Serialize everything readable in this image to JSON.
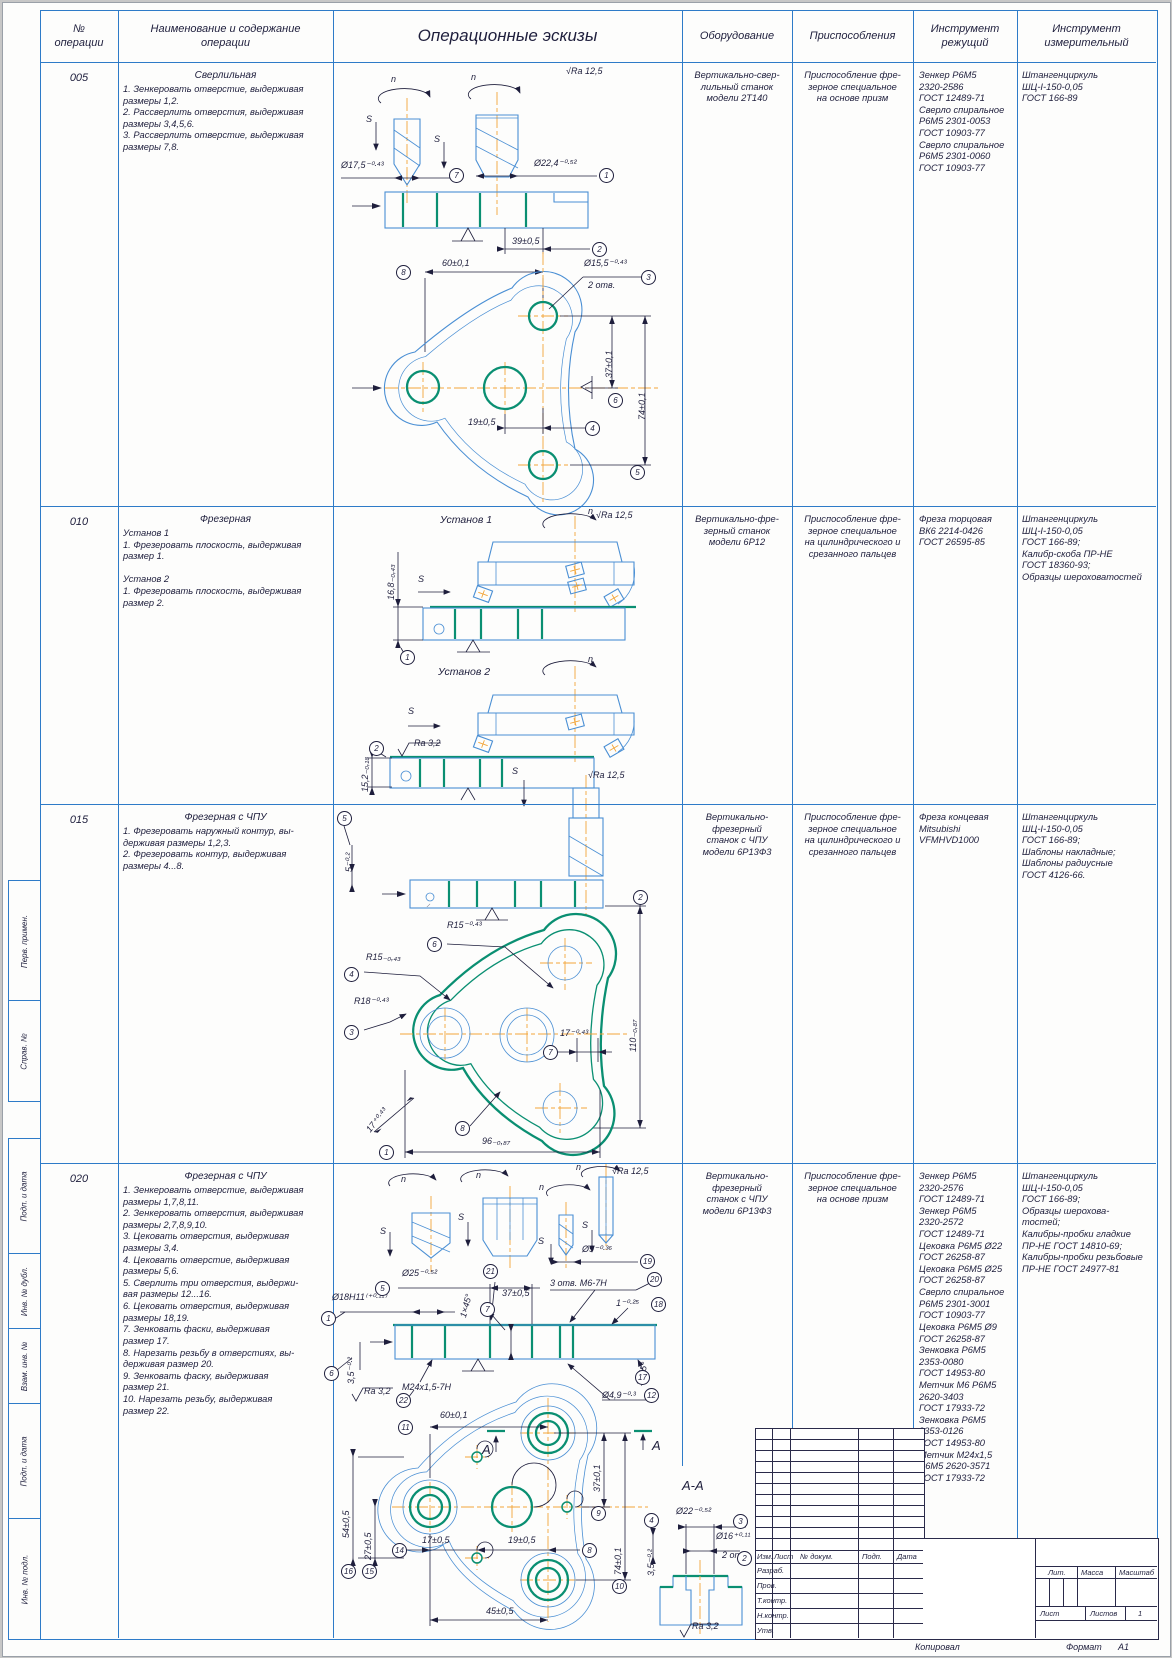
{
  "header": {
    "col_op_num": "№\nоперации",
    "col_name": "Наименование и содержание\nоперации",
    "col_sketch": "Операционные эскизы",
    "col_equipment": "Оборудование",
    "col_fixture": "Приспособления",
    "col_cutting": "Инструмент\nрежущий",
    "col_measuring": "Инструмент\nизмерительный"
  },
  "operations": [
    {
      "num": "005",
      "title": "Сверлильная",
      "steps": "1. Зенкеровать отверстие, выдерживая\nразмеры 1,2.\n2. Рассверлить отверстия, выдерживая\nразмеры 3,4,5,6.\n3. Рассверлить отверстие, выдерживая\nразмеры 7,8.",
      "equipment": "Вертикально-свер-\nлильный станок\nмодели 2Т140",
      "fixture": "Приспособление фре-\nзерное специальное\nна основе призм",
      "cutting": "Зенкер Р6М5\n2320-2586\nГОСТ 12489-71\nСверло спиральное\nР6М5 2301-0053\nГОСТ 10903-77\nСверло спиральное\nР6М5 2301-0060\nГОСТ 10903-77",
      "measuring": "Штангенциркуль\nШЦ-I-150-0,05\nГОСТ 166-89"
    },
    {
      "num": "010",
      "title": "Фрезерная",
      "steps": "Установ 1\n1. Фрезеровать плоскость, выдерживая\nразмер 1.\n\nУстанов 2\n1. Фрезеровать плоскость, выдерживая\nразмер 2.",
      "equipment": "Вертикально-фре-\nзерный станок\nмодели 6Р12",
      "fixture": "Приспособление фре-\nзерное специальное\nна цилиндрического и\nсрезанного пальцев",
      "cutting": "Фреза торцовая\nВК6 2214-0426\nГОСТ 26595-85",
      "measuring": "Штангенциркуль\nШЦ-I-150-0,05\nГОСТ 166-89;\nКалибр-скоба ПР-НЕ\nГОСТ 18360-93;\nОбразцы шероховатостей"
    },
    {
      "num": "015",
      "title": "Фрезерная с ЧПУ",
      "steps": "1. Фрезеровать наружный контур, вы-\nдерживая размеры 1,2,3.\n2. Фрезеровать контур, выдерживая\nразмеры 4...8.",
      "equipment": "Вертикально-\nфрезерный\nстанок с ЧПУ\nмодели 6Р13Ф3",
      "fixture": "Приспособление фре-\nзерное специальное\nна цилиндрического и\nсрезанного пальцев",
      "cutting": "Фреза концевая\nMitsubishi\nVFMHVD1000",
      "measuring": "Штангенциркуль\nШЦ-I-150-0,05\nГОСТ 166-89;\nШаблоны накладные;\nШаблоны радиусные\nГОСТ 4126-66."
    },
    {
      "num": "020",
      "title": "Фрезерная с ЧПУ",
      "steps": "1. Зенкеровать отверстие, выдерживая\nразмеры 1,7,8,11.\n2. Зенкеровать отверстия, выдерживая\nразмеры 2,7,8,9,10.\n3. Цековать отверстия, выдерживая\nразмеры 3,4.\n4. Цековать отверстие, выдерживая\nразмеры 5,6.\n5. Сверлить три отверстия, выдержи-\nвая размеры 12...16.\n6. Цековать отверстия, выдерживая\nразмеры 18,19.\n7. Зенковать фаски, выдерживая\nразмер 17.\n8. Нарезать резьбу в отверстиях, вы-\nдерживая размер 20.\n9. Зенковать фаску, выдерживая\nразмер 21.\n10. Нарезать резьбу, выдерживая\nразмер 22.",
      "equipment": "Вертикально-\nфрезерный\nстанок с ЧПУ\nмодели 6Р13Ф3",
      "fixture": "Приспособление фре-\nзерное специальное\nна основе призм",
      "cutting": "Зенкер Р6М5\n2320-2576\nГОСТ 12489-71\nЗенкер Р6М5\n2320-2572\nГОСТ 12489-71\nЦековка Р6М5 Ø22\nГОСТ 26258-87\nЦековка Р6М5 Ø25\nГОСТ 26258-87\nСверло спиральное\nР6М5 2301-3001\nГОСТ 10903-77\nЦековка Р6М5 Ø9\nГОСТ 26258-87\nЗенковка Р6М5\n2353-0080\nГОСТ 14953-80\nМетчик М6 Р6М5\n2620-3403\nГОСТ 17933-72\nЗенковка Р6М5\n2353-0126\nГОСТ 14953-80\nМетчик М24х1,5\nР6М5 2620-3571\nГОСТ 17933-72",
      "measuring": "Штангенциркуль\nШЦ-I-150-0,05\nГОСТ 166-89;\nОбразцы шерохова-\nтостей;\nКалибры-пробки гладкие\nПР-НЕ ГОСТ 14810-69;\nКалибры-пробки резьбовые\nПР-НЕ ГОСТ 24977-81"
    }
  ],
  "annotations": [
    {
      "t": "√Ra 12,5",
      "x": 566,
      "y": 66
    },
    {
      "t": "n",
      "x": 391,
      "y": 74
    },
    {
      "t": "n",
      "x": 471,
      "y": 72
    },
    {
      "t": "S",
      "x": 366,
      "y": 114
    },
    {
      "t": "S",
      "x": 434,
      "y": 134
    },
    {
      "t": "Ø17,5⁻⁰·⁴³",
      "x": 341,
      "y": 160
    },
    {
      "t": "Ø22,4⁻⁰·⁵²",
      "x": 534,
      "y": 158
    },
    {
      "t": "39±0,5",
      "x": 512,
      "y": 236
    },
    {
      "t": "60±0,1",
      "x": 442,
      "y": 258
    },
    {
      "t": "Ø15,5⁻⁰·⁴³",
      "x": 584,
      "y": 258
    },
    {
      "t": "2 отв.",
      "x": 588,
      "y": 280
    },
    {
      "t": "37±0,1",
      "x": 604,
      "y": 378,
      "r": -90
    },
    {
      "t": "74±0,1",
      "x": 637,
      "y": 420,
      "r": -90
    },
    {
      "t": "19±0,5",
      "x": 468,
      "y": 417
    },
    {
      "t": "Установ 1",
      "x": 440,
      "y": 514,
      "s": 10.5
    },
    {
      "t": "√Ra 12,5",
      "x": 596,
      "y": 510
    },
    {
      "t": "n",
      "x": 588,
      "y": 506
    },
    {
      "t": "S",
      "x": 418,
      "y": 574
    },
    {
      "t": "16,8₋₀,₄₃",
      "x": 386,
      "y": 600,
      "r": -90
    },
    {
      "t": "Установ 2",
      "x": 438,
      "y": 666,
      "s": 10.5
    },
    {
      "t": "n",
      "x": 588,
      "y": 654
    },
    {
      "t": "S",
      "x": 408,
      "y": 706
    },
    {
      "t": "Ra 3,2",
      "x": 414,
      "y": 738
    },
    {
      "t": "15,2₋₀,₁₈",
      "x": 360,
      "y": 792,
      "r": -90
    },
    {
      "t": "√Ra 12,5",
      "x": 588,
      "y": 770
    },
    {
      "t": "S",
      "x": 512,
      "y": 766
    },
    {
      "t": "5⁻⁰·²",
      "x": 344,
      "y": 872,
      "r": -90
    },
    {
      "t": "R15⁻⁰·⁴³",
      "x": 447,
      "y": 920
    },
    {
      "t": "R15₋₀,₄₃",
      "x": 366,
      "y": 952
    },
    {
      "t": "R18⁻⁰·⁴³",
      "x": 354,
      "y": 996
    },
    {
      "t": "17⁻⁰·⁴³",
      "x": 560,
      "y": 1028
    },
    {
      "t": "110₋₀,₈₇",
      "x": 628,
      "y": 1052,
      "r": -90
    },
    {
      "t": "17⁺⁰·⁴³",
      "x": 364,
      "y": 1128,
      "r": -52
    },
    {
      "t": "96₋₀,₈₇",
      "x": 482,
      "y": 1136
    },
    {
      "t": "n",
      "x": 401,
      "y": 1174
    },
    {
      "t": "n",
      "x": 476,
      "y": 1170
    },
    {
      "t": "n",
      "x": 539,
      "y": 1182
    },
    {
      "t": "n",
      "x": 576,
      "y": 1162
    },
    {
      "t": "√Ra 12,5",
      "x": 612,
      "y": 1166
    },
    {
      "t": "S",
      "x": 380,
      "y": 1226
    },
    {
      "t": "S",
      "x": 458,
      "y": 1212
    },
    {
      "t": "S",
      "x": 538,
      "y": 1236
    },
    {
      "t": "S",
      "x": 582,
      "y": 1220
    },
    {
      "t": "Ø9⁻⁰·³⁶",
      "x": 582,
      "y": 1244
    },
    {
      "t": "Ø25⁻⁰·⁵²",
      "x": 402,
      "y": 1268
    },
    {
      "t": "Ø18Н11⁽⁺⁰·¹¹⁾",
      "x": 332,
      "y": 1292
    },
    {
      "t": "1×45°",
      "x": 458,
      "y": 1316,
      "r": -75
    },
    {
      "t": "37±0,5",
      "x": 502,
      "y": 1288
    },
    {
      "t": "3 отв. М6-7Н",
      "x": 550,
      "y": 1278
    },
    {
      "t": "1⁻⁰·²⁵",
      "x": 616,
      "y": 1298
    },
    {
      "t": "3,5⁻⁰·²",
      "x": 346,
      "y": 1384,
      "r": -90
    },
    {
      "t": "М24х1,5-7Н",
      "x": 402,
      "y": 1382
    },
    {
      "t": "Ra 3,2",
      "x": 364,
      "y": 1386
    },
    {
      "t": "1×45°",
      "x": 634,
      "y": 1384,
      "r": -75
    },
    {
      "t": "Ø4,9⁻⁰·³",
      "x": 602,
      "y": 1390
    },
    {
      "t": "60±0,1",
      "x": 440,
      "y": 1410
    },
    {
      "t": "54±0,5",
      "x": 341,
      "y": 1538,
      "r": -90
    },
    {
      "t": "27±0,5",
      "x": 363,
      "y": 1560,
      "r": -90
    },
    {
      "t": "17±0,5",
      "x": 422,
      "y": 1535
    },
    {
      "t": "19±0,5",
      "x": 508,
      "y": 1535
    },
    {
      "t": "37±0,1",
      "x": 592,
      "y": 1492,
      "r": -90
    },
    {
      "t": "74±0,1",
      "x": 613,
      "y": 1575,
      "r": -90
    },
    {
      "t": "45±0,5",
      "x": 486,
      "y": 1606
    },
    {
      "t": "А",
      "x": 482,
      "y": 1442,
      "s": 13
    },
    {
      "t": "А",
      "x": 652,
      "y": 1438,
      "s": 13
    },
    {
      "t": "А-А",
      "x": 682,
      "y": 1478,
      "s": 13
    },
    {
      "t": "Ø22⁻⁰·⁵²",
      "x": 676,
      "y": 1506
    },
    {
      "t": "Ø16⁺⁰·¹¹",
      "x": 716,
      "y": 1531
    },
    {
      "t": "2 отв.",
      "x": 722,
      "y": 1550
    },
    {
      "t": "3,5⁻⁰·²",
      "x": 646,
      "y": 1576,
      "r": -90
    },
    {
      "t": "Ra 3,2",
      "x": 692,
      "y": 1621
    }
  ],
  "balloons": [
    {
      "n": "7",
      "x": 449,
      "y": 168
    },
    {
      "n": "1",
      "x": 599,
      "y": 168
    },
    {
      "n": "2",
      "x": 592,
      "y": 242
    },
    {
      "n": "8",
      "x": 396,
      "y": 265
    },
    {
      "n": "3",
      "x": 641,
      "y": 270
    },
    {
      "n": "6",
      "x": 608,
      "y": 393
    },
    {
      "n": "5",
      "x": 630,
      "y": 465
    },
    {
      "n": "4",
      "x": 585,
      "y": 421
    },
    {
      "n": "1",
      "x": 400,
      "y": 650
    },
    {
      "n": "2",
      "x": 369,
      "y": 741
    },
    {
      "n": "5",
      "x": 337,
      "y": 811
    },
    {
      "n": "2",
      "x": 633,
      "y": 890
    },
    {
      "n": "6",
      "x": 427,
      "y": 937
    },
    {
      "n": "4",
      "x": 344,
      "y": 967
    },
    {
      "n": "3",
      "x": 344,
      "y": 1025
    },
    {
      "n": "7",
      "x": 543,
      "y": 1045
    },
    {
      "n": "8",
      "x": 455,
      "y": 1121
    },
    {
      "n": "1",
      "x": 379,
      "y": 1145
    },
    {
      "n": "19",
      "x": 640,
      "y": 1254
    },
    {
      "n": "5",
      "x": 375,
      "y": 1281
    },
    {
      "n": "1",
      "x": 321,
      "y": 1311
    },
    {
      "n": "21",
      "x": 483,
      "y": 1264
    },
    {
      "n": "7",
      "x": 480,
      "y": 1302
    },
    {
      "n": "20",
      "x": 647,
      "y": 1272
    },
    {
      "n": "18",
      "x": 651,
      "y": 1297
    },
    {
      "n": "6",
      "x": 324,
      "y": 1366
    },
    {
      "n": "22",
      "x": 396,
      "y": 1393
    },
    {
      "n": "17",
      "x": 635,
      "y": 1370
    },
    {
      "n": "12",
      "x": 644,
      "y": 1388
    },
    {
      "n": "11",
      "x": 398,
      "y": 1420
    },
    {
      "n": "16",
      "x": 341,
      "y": 1564
    },
    {
      "n": "15",
      "x": 362,
      "y": 1564
    },
    {
      "n": "14",
      "x": 392,
      "y": 1543
    },
    {
      "n": "8",
      "x": 582,
      "y": 1543
    },
    {
      "n": "9",
      "x": 591,
      "y": 1506
    },
    {
      "n": "10",
      "x": 612,
      "y": 1579
    },
    {
      "n": "4",
      "x": 644,
      "y": 1513
    },
    {
      "n": "3",
      "x": 733,
      "y": 1514
    },
    {
      "n": "2",
      "x": 737,
      "y": 1551
    }
  ],
  "side_labels": [
    {
      "t": "Перв. примен.",
      "y1": 880,
      "y2": 1000
    },
    {
      "t": "Справ. №",
      "y1": 1000,
      "y2": 1100
    },
    {
      "t": "Подп. и дата",
      "y1": 1138,
      "y2": 1253
    },
    {
      "t": "Инв. № дубл.",
      "y1": 1253,
      "y2": 1328
    },
    {
      "t": "Взам. инв. №",
      "y1": 1328,
      "y2": 1403
    },
    {
      "t": "Подп. и дата",
      "y1": 1403,
      "y2": 1518
    },
    {
      "t": "Инв. № подл.",
      "y1": 1518,
      "y2": 1638
    }
  ],
  "title_block": {
    "rev_cols": [
      "Изм.",
      "Лист",
      "№ докум.",
      "Подп.",
      "Дата"
    ],
    "sig_rows": [
      "Разраб.",
      "Пров.",
      "Т.контр.",
      "Н.контр.",
      "Утв."
    ],
    "lit_label": "Лит.",
    "mass_label": "Масса",
    "scale_label": "Масштаб",
    "sheet_label": "Лист",
    "sheets_label": "Листов",
    "sheets_value": "1"
  },
  "footer": {
    "copied": "Копировал",
    "format_label": "Формат",
    "format_value": "А1"
  }
}
